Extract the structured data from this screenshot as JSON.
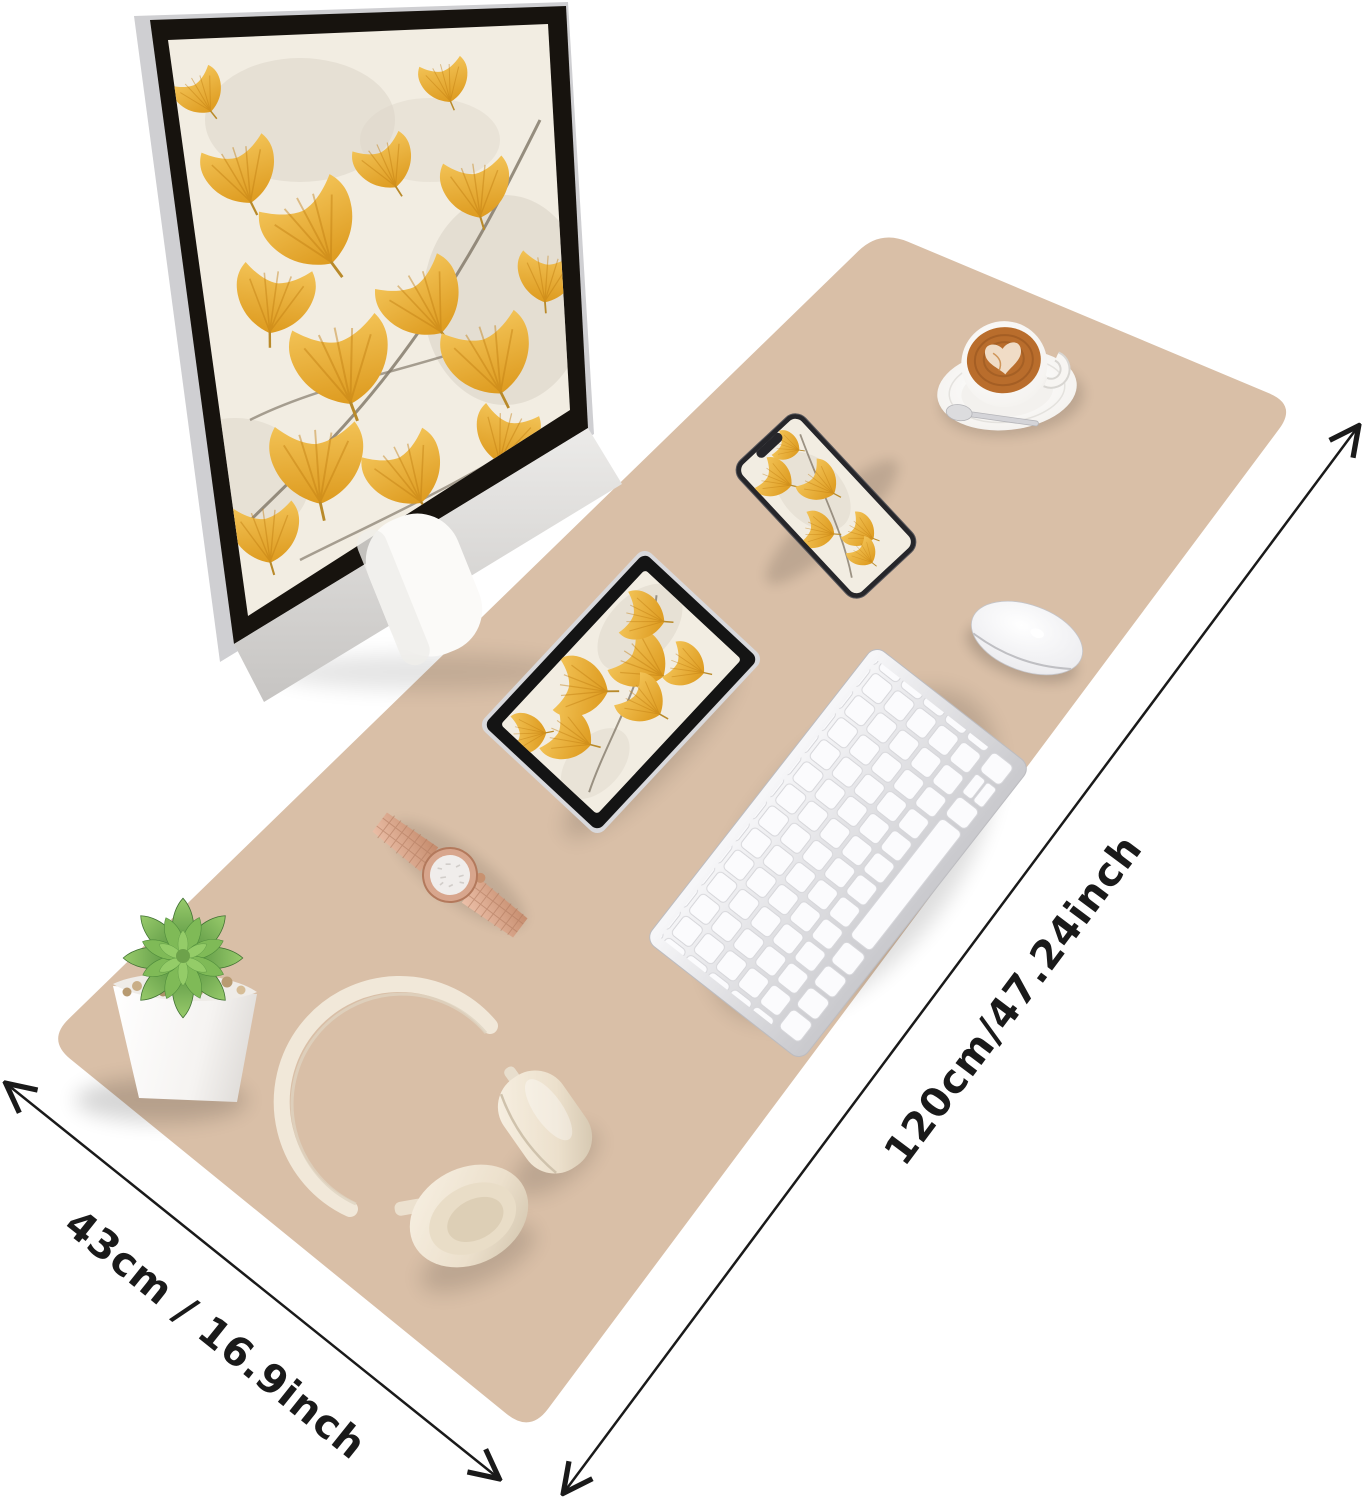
{
  "meta": {
    "image_type": "product-photo",
    "subject": "large desk pad mouse mat with desk setup and printed size arrows"
  },
  "labels": {
    "length": "120cm/47.24inch",
    "width": "43cm / 16.9inch"
  },
  "colors": {
    "background": "#ffffff",
    "mat": "#d9bfa7",
    "arrow": "#1a1a1a",
    "gold": "#f2c255",
    "gold_deep": "#dd9a1e",
    "screen_bg": "#f2ede2",
    "bezel": "#17130e",
    "silver": "#d2d2d5",
    "cream": "#f1e8d9",
    "rose_gold": "#d8a68d",
    "succulent_green": "#6fae52",
    "coffee_brown": "#b96d2c"
  },
  "objects": {
    "mat": "desk-pad",
    "monitor": "desktop-monitor with ginkgo wallpaper",
    "tablet": "tablet with ginkgo wallpaper",
    "phone": "smartphone with ginkgo wallpaper",
    "keyboard": "white wireless keyboard",
    "mouse": "white wireless mouse",
    "coffee": "latte cup with heart art on saucer with spoon",
    "watch": "rose-gold bracelet watch",
    "plant": "succulent in white square pot",
    "headphones": "cream wireless headphones"
  }
}
